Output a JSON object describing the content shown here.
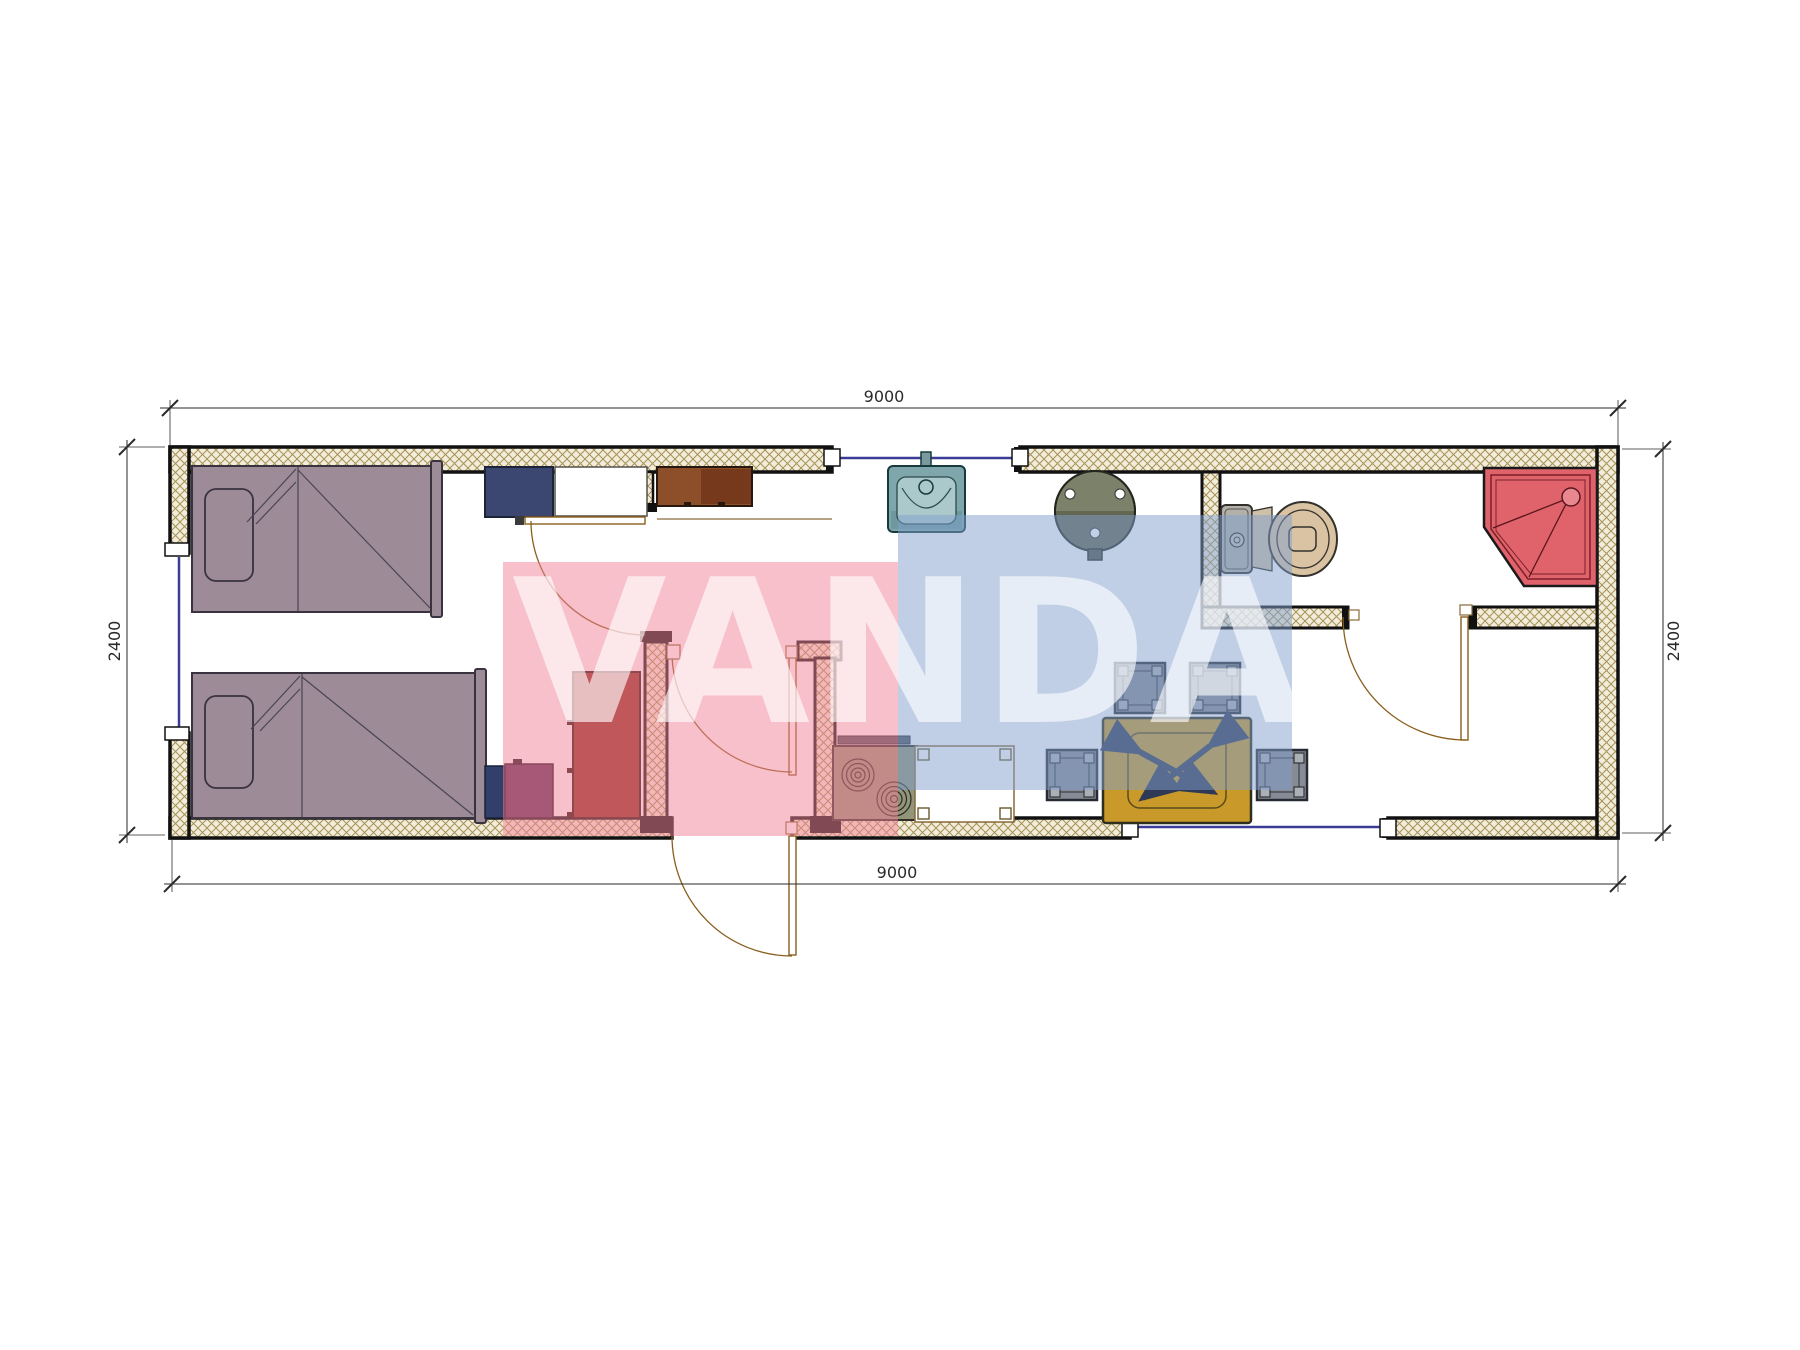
{
  "watermark": {
    "text": "VANDA",
    "pink_block_color": "rgba(242,130,150,0.5)",
    "blue_block_color": "rgba(130,160,205,0.5)",
    "text_color": "rgba(255,255,255,0.62)"
  },
  "dimensions": {
    "top_width": "9000",
    "bottom_width": "9000",
    "left_height": "2400",
    "right_height": "2400"
  },
  "colors": {
    "wall_hatch_bg": "#f2ecda",
    "wall_hatch_line": "#a69256",
    "wall_border": "#111111",
    "window_glass": "#3b3b98",
    "door": "#8a5f1e",
    "dim": "#2a2a2a",
    "bed": "#9d8c98",
    "bed_outline": "#39323f",
    "wardrobe_navy": "#3b4671",
    "shelf_white": "#ffffff",
    "cabinet_brown": "#8d4e2a",
    "cabinet_brown_dark": "#77391c",
    "cabinet_maroon": "#8f2d20",
    "box_navy": "#333f6b",
    "box_purple": "#5c2f56",
    "sink_outer": "#7fa6ab",
    "sink_inner": "#abc8ca",
    "sink_band": "#6d989c",
    "heater_top": "#7c8169",
    "heater_bottom": "#636751",
    "stove": "#939579",
    "stove_bar": "#4e545e",
    "counter_fill": "#ffffff",
    "counter_border": "#8a6a3a",
    "stool_fill": "#868b95",
    "stool_dark": "#262b33",
    "stool_corner": "#aab0b8",
    "table_fill": "#c9992a",
    "table_legs": "#2e3a55",
    "toilet_tank": "#b3b0a9",
    "toilet_bowl": "#d9c3a3",
    "shower_fill": "#e0636c",
    "shower_line": "#7a2028"
  },
  "plan": {
    "overall_size_mm": {
      "length": "9000",
      "width": "2400"
    },
    "furniture": [
      "bed-1",
      "bed-2",
      "wardrobe-navy",
      "shelf-cabinet",
      "upper-cabinet-brown",
      "tall-cabinet-maroon",
      "nightstand-navy",
      "dresser-purple",
      "kitchen-sink",
      "water-heater-round",
      "stove-two-burner",
      "kitchen-counter",
      "stool-1",
      "stool-2",
      "stool-3",
      "stool-4",
      "dining-table-folding",
      "toilet",
      "corner-shower-tray"
    ],
    "doors": [
      "bedroom-door",
      "hall-door",
      "entry-door",
      "bathroom-door"
    ],
    "windows": [
      "top-wall-window",
      "left-wall-window",
      "bottom-wall-window"
    ]
  }
}
